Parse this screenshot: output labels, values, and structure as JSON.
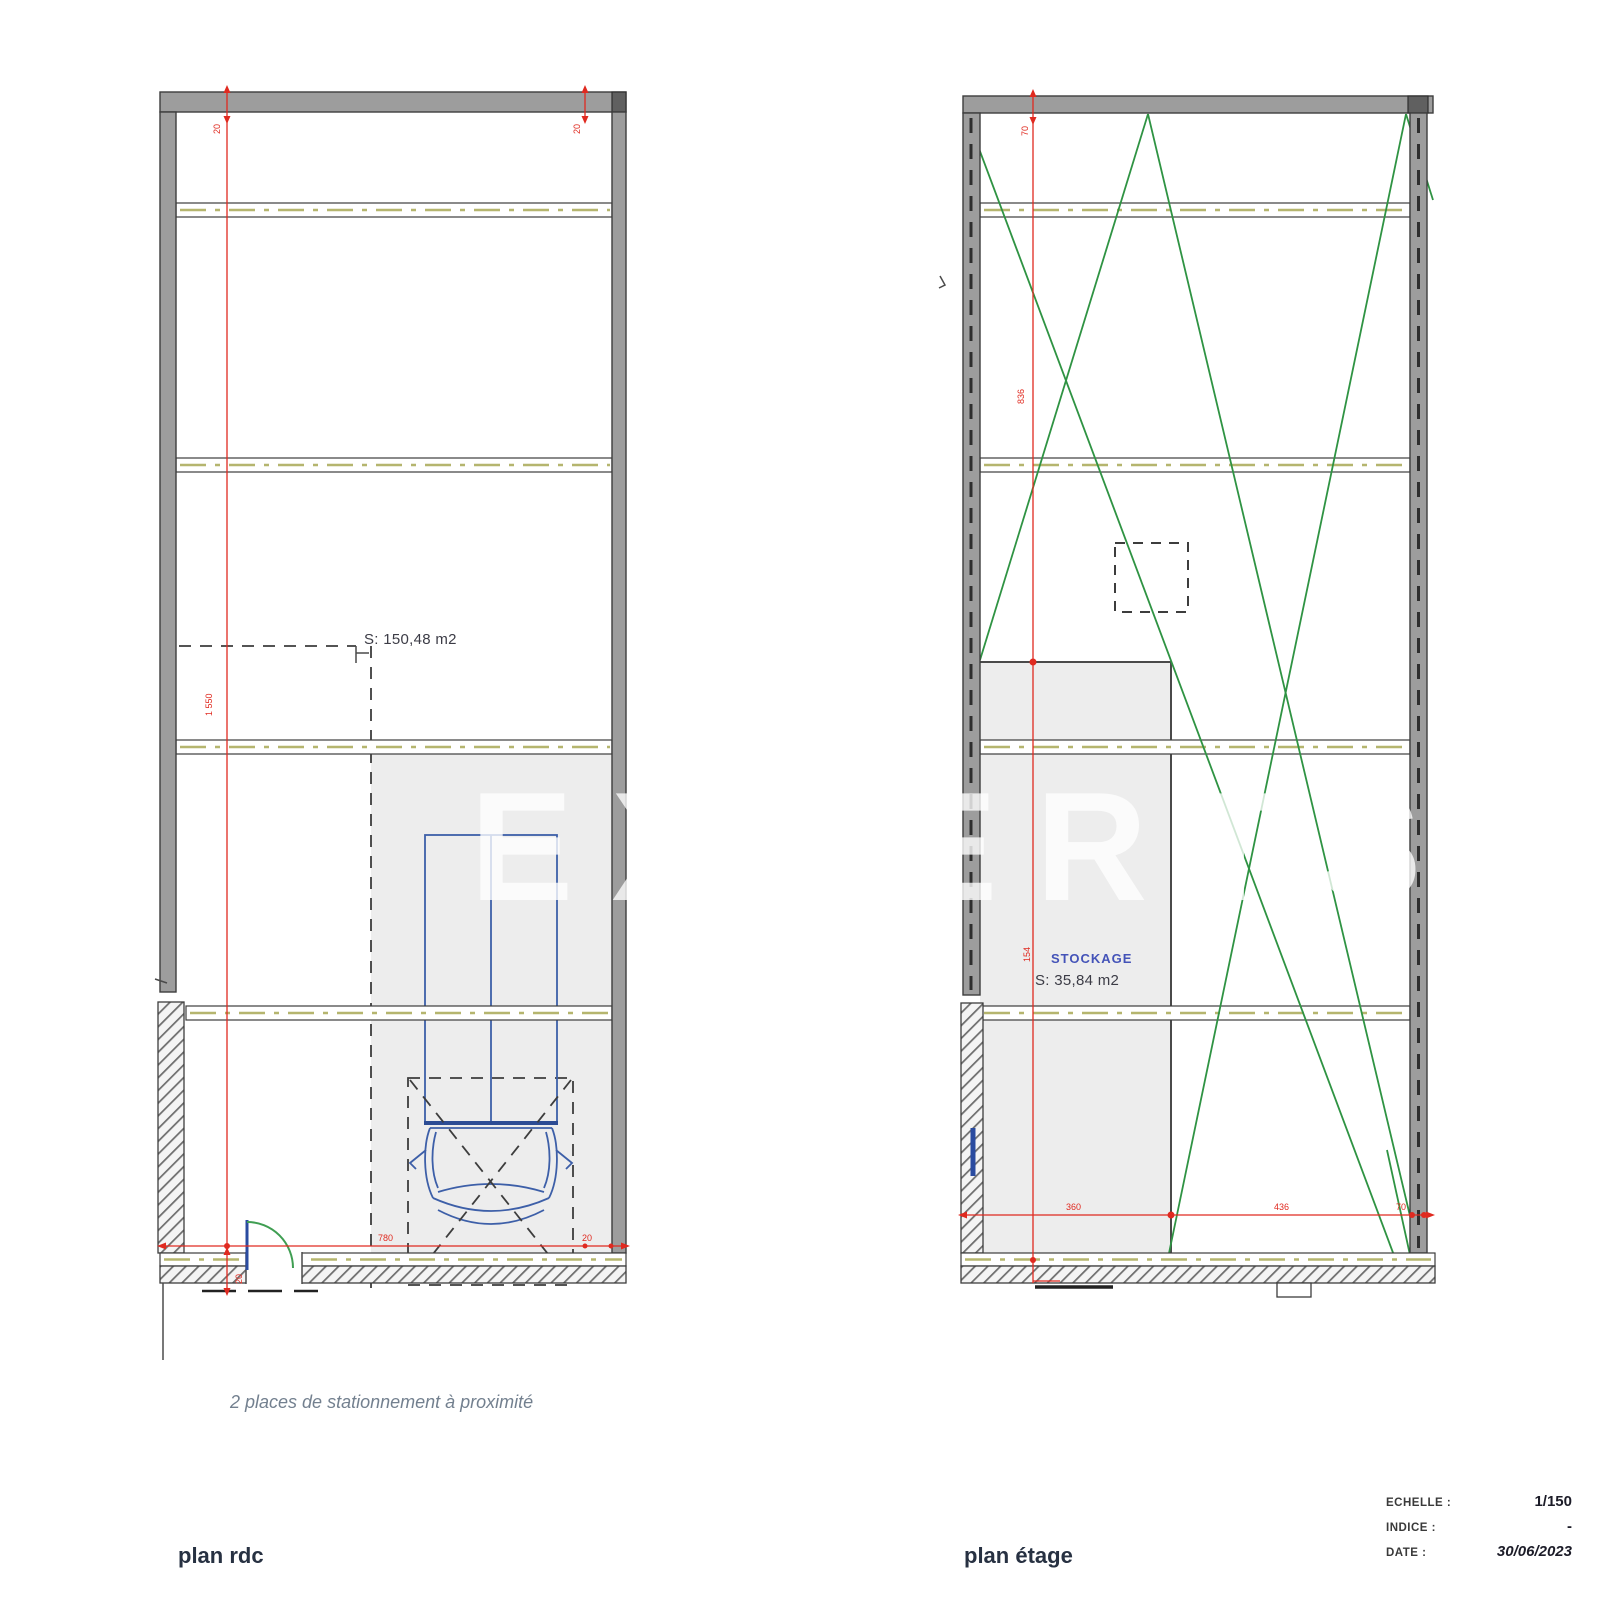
{
  "watermark": {
    "text": "EXPERTS"
  },
  "plan_rdc": {
    "label": "plan rdc",
    "area": "S: 150,48 m2",
    "note": "2 places de stationnement à proximité",
    "dim_top_left": "20",
    "dim_top_right": "20",
    "dim_left_height": "1 550",
    "dim_bottom_width": "780",
    "dim_bottom_right": "20",
    "dim_door": "20"
  },
  "plan_etage": {
    "label": "plan étage",
    "room": "STOCKAGE",
    "area": "S: 35,84 m2",
    "dim_top": "70",
    "dim_upper_height": "836",
    "dim_lower_height": "154",
    "dim_bottom_left": "360",
    "dim_bottom_mid": "436",
    "dim_bottom_right": "70"
  },
  "titleblock": {
    "scale_label": "ECHELLE :",
    "scale_value": "1/150",
    "indice_label": "INDICE :",
    "indice_value": "-",
    "date_label": "DATE :",
    "date_value": "30/06/2023"
  },
  "colors": {
    "dimension_red": "#e02a20",
    "bracing_green": "#2f9343",
    "vehicle_blue": "#3d5fa8",
    "wall_gray": "#9d9d9d",
    "zone_gray": "#ededed",
    "room_label_blue": "#4453b8"
  }
}
